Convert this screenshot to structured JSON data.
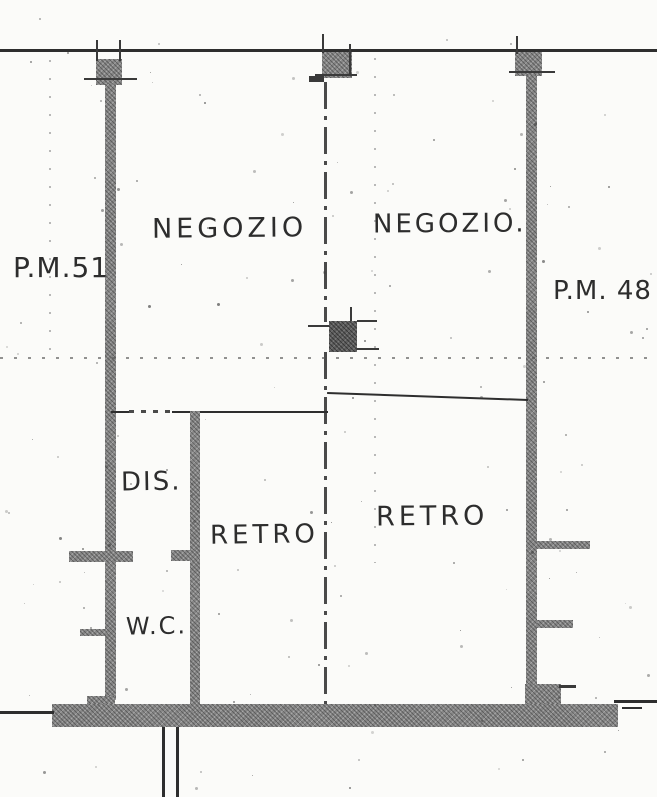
{
  "plan": {
    "labels": {
      "negozio_left": "NEGOZIO",
      "negozio_right": "NEGOZIO.",
      "pm_left": "P.M.51",
      "pm_right": "P.M. 48",
      "dis": "DIS.",
      "retro_left": "RETRO",
      "retro_right": "RETRO",
      "wc": "W.C."
    },
    "colors": {
      "wall_fill": "#878787",
      "pillar_dark_fill": "#5e5e5e",
      "line": "#2e2e2e",
      "paper": "#fbfbf9"
    }
  }
}
